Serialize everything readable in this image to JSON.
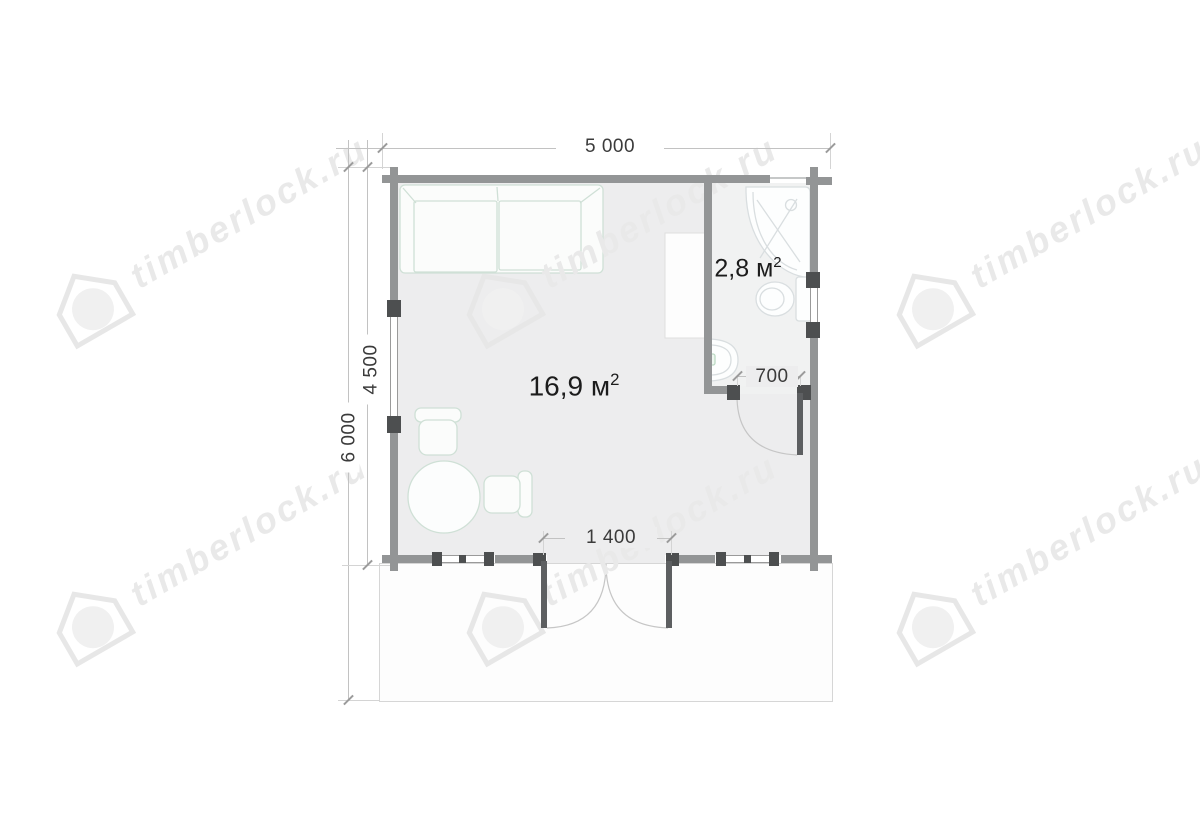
{
  "plan": {
    "dimensions": {
      "top_width": "5 000",
      "inner_height": "4 500",
      "total_height": "6 000",
      "bath_door_width": "700",
      "main_door_width": "1 400"
    },
    "rooms": {
      "main": {
        "area": "16,9 м",
        "area_sup": "2"
      },
      "bathroom": {
        "area": "2,8 м",
        "area_sup": "2"
      }
    }
  },
  "watermark": {
    "text": "timberlock.ru"
  },
  "colors": {
    "wall": "#939596",
    "wall_dark": "#4d4f50",
    "door_leaf": "#5d5f61",
    "room_fill": "#ededee",
    "bathroom_fill": "#f1f2f2",
    "terrace_fill": "#fdfdfd",
    "furniture_stroke": "#cfe0d6",
    "fixture_stroke": "#d9dee0",
    "faucet_accent": "#bcd9c4",
    "dimension_text": "#3b3b3b",
    "watermark_gray": "#e9e9e9"
  }
}
